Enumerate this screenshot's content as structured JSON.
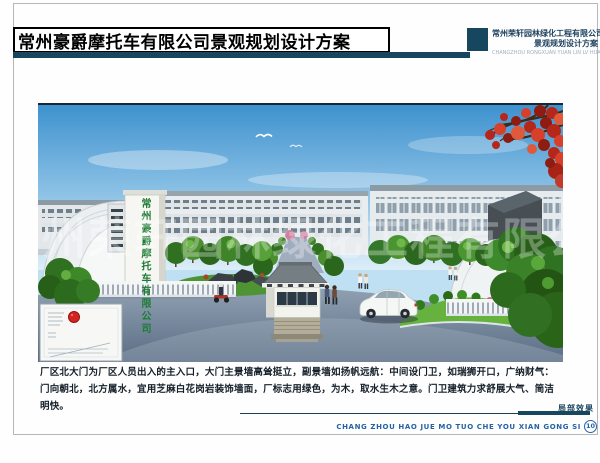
{
  "header": {
    "title": "常州豪爵摩托车有限公司景观规划设计方案",
    "company_name": "常州荣轩园林绿化工程有限公司",
    "company_subtitle": "景观规划设计方案",
    "company_en": "CHANGZHOU RONGXUAN YUAN LIN LV HUA"
  },
  "rendering": {
    "gate_wall_text": "常州豪爵摩托车有限公司",
    "watermark_text": "常州荣轩园林绿化工程有限公司"
  },
  "description": "厂区北大门为厂区人员出入的主入口，大门主景墙高耸挺立，副景墙如扬帆远航：中间设门卫，如瑞狮开口，广纳财气：门向朝北，北方属水，宜用芝麻白花岗岩装饰墙面，厂标志用绿色，为木，取水生木之意。门卫建筑力求舒展大气、简洁明快。",
  "footer": {
    "caption": "局部效果",
    "pinyin_title": "CHANG ZHOU HAO JUE MO TUO CHE YOU XIAN GONG SI",
    "page_number": "10"
  },
  "colors": {
    "navy": "#17475f",
    "footer_blue": "#2563a8",
    "gate_text_green": "#1e7c35",
    "marker_red": "#d42420"
  }
}
